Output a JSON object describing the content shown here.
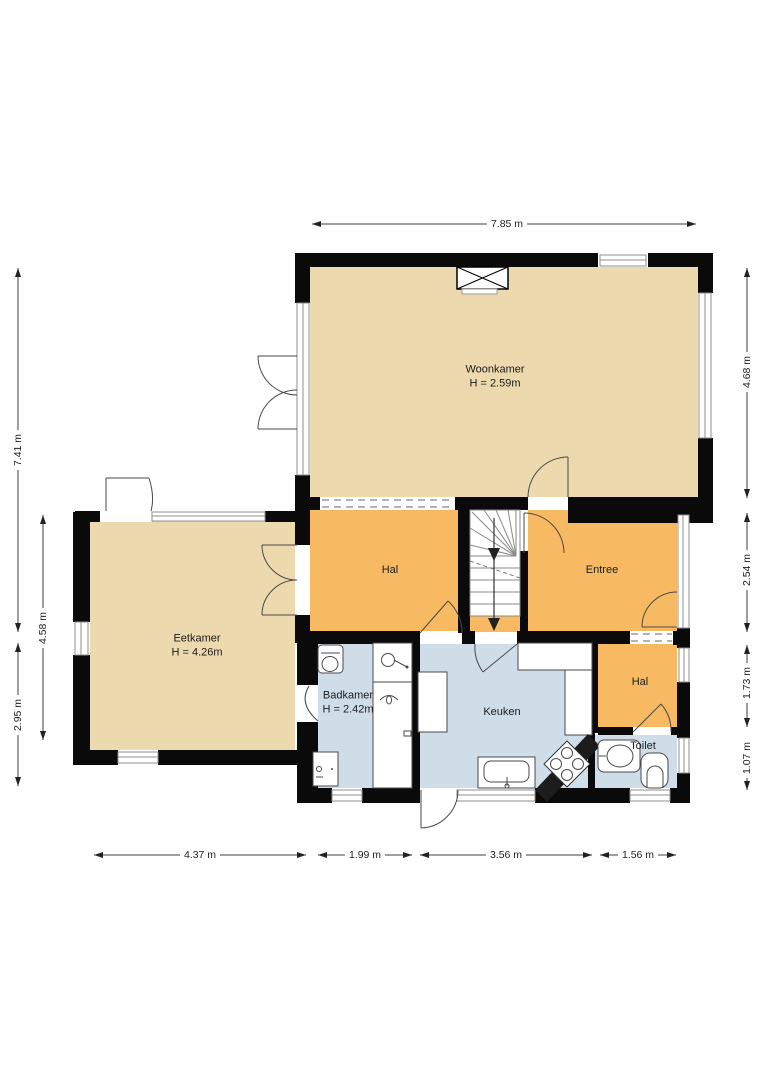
{
  "plan": {
    "rooms": [
      {
        "id": "woonkamer",
        "label": "Woonkamer",
        "height": "H = 2.59m"
      },
      {
        "id": "eetkamer",
        "label": "Eetkamer",
        "height": "H = 4.26m"
      },
      {
        "id": "hal",
        "label": "Hal",
        "height": ""
      },
      {
        "id": "entree",
        "label": "Entree",
        "height": ""
      },
      {
        "id": "badkamer",
        "label": "Badkamer",
        "height": "H = 2.42m"
      },
      {
        "id": "keuken",
        "label": "Keuken",
        "height": ""
      },
      {
        "id": "hal2",
        "label": "Hal",
        "height": ""
      },
      {
        "id": "toilet",
        "label": "Toilet",
        "height": ""
      }
    ],
    "dimensions": {
      "top": [
        {
          "value": "7.85 m"
        }
      ],
      "bottom": [
        {
          "value": "4.37 m"
        },
        {
          "value": "1.99 m"
        },
        {
          "value": "3.56 m"
        },
        {
          "value": "1.56 m"
        }
      ],
      "left": [
        {
          "value": "7.41 m"
        },
        {
          "value": "4.58 m"
        },
        {
          "value": "2.95 m"
        }
      ],
      "right": [
        {
          "value": "4.68 m"
        },
        {
          "value": "2.54 m"
        },
        {
          "value": "1.73 m"
        },
        {
          "value": "1.07 m"
        }
      ]
    },
    "colors": {
      "living": "#ecd9ae",
      "circulation": "#f7ba62",
      "wet": "#cfdde9",
      "wall": "#0a0a0a",
      "line": "#4a4a4a"
    }
  }
}
